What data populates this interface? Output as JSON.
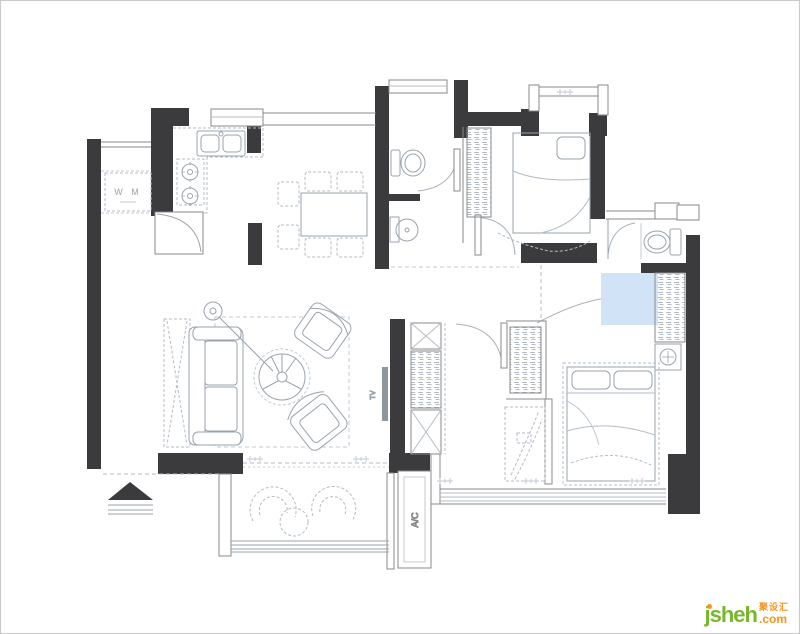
{
  "page": {
    "background": "#ffffff",
    "frame_border": "#c9c9c9"
  },
  "floor_plan": {
    "kind": "apartment floor plan drawing",
    "wall_color": "#3b3b3d",
    "thin_wall_color": "#8a8a8a",
    "furniture_line_color": "#9aa3ad",
    "dashed_line_color": "#b4bcc4",
    "highlight_color": "#cfe2f6",
    "labels": {
      "washing_machine": "W M",
      "tv": "TV",
      "ac_platform": "A/C"
    }
  },
  "watermark": {
    "brand": "jsheh",
    "tld": ".com",
    "cjk_name": "聚设汇",
    "green": "#76b82a",
    "orange": "#f7941e"
  }
}
